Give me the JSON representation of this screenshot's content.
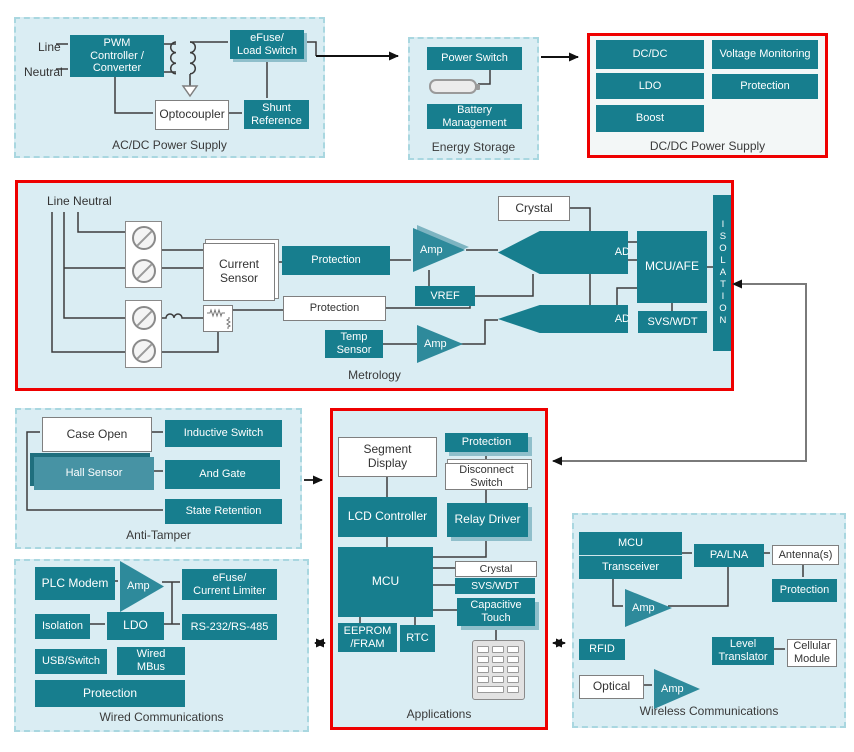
{
  "colors": {
    "teal": "#177E8E",
    "teal_light": "#4793A4",
    "amp_teal": "#2E8A9B",
    "container_bg": "#DAEDF3",
    "container_border": "#A9D7E0",
    "highlight_red": "#EE0000",
    "wire": "#3C3C3C",
    "link_gray": "#7A7A7A"
  },
  "acdc": {
    "title": "AC/DC Power Supply",
    "line_label": "Line",
    "neutral_label": "Neutral",
    "pwm": "PWM\nController /\nConverter",
    "efuse": "eFuse/\nLoad Switch",
    "optocoupler": "Optocoupler",
    "shunt_reference": "Shunt\nReference"
  },
  "energy": {
    "title": "Energy Storage",
    "power_switch": "Power Switch",
    "battery_management": "Battery\nManagement"
  },
  "dcdc": {
    "title": "DC/DC Power Supply",
    "dcdc": "DC/DC",
    "voltage_monitoring": "Voltage Monitoring",
    "ldo": "LDO",
    "protection": "Protection",
    "boost": "Boost"
  },
  "metrology": {
    "title": "Metrology",
    "line_neutral": "Line Neutral",
    "current_sensor": "Current\nSensor",
    "protection_top": "Protection",
    "protection_bottom": "Protection",
    "temp_sensor": "Temp\nSensor",
    "amp_top": "Amp",
    "amp_bottom": "Amp",
    "adc_top": "ADC",
    "adc_bottom": "ADC",
    "vref": "VREF",
    "crystal": "Crystal",
    "mcu_afe": "MCU/AFE",
    "svs_wdt": "SVS/WDT",
    "isolation": "ISOLATION"
  },
  "anti_tamper": {
    "title": "Anti-Tamper",
    "case_open": "Case Open",
    "inductive_switch": "Inductive Switch",
    "hall_sensor": "Hall Sensor",
    "and_gate": "And Gate",
    "state_retention": "State Retention"
  },
  "applications": {
    "title": "Applications",
    "segment_display": "Segment\nDisplay",
    "protection": "Protection",
    "disconnect_switch": "Disconnect\nSwitch",
    "lcd_controller": "LCD Controller",
    "relay_driver": "Relay Driver",
    "mcu": "MCU",
    "crystal": "Crystal",
    "svs_wdt": "SVS/WDT",
    "capacitive_touch": "Capacitive\nTouch",
    "eeprom_fram": "EEPROM\n/FRAM",
    "rtc": "RTC"
  },
  "wired": {
    "title": "Wired Communications",
    "plc_modem": "PLC Modem",
    "amp": "Amp",
    "efuse_current_limiter": "eFuse/\nCurrent Limiter",
    "isolation": "Isolation",
    "ldo": "LDO",
    "rs232_rs485": "RS-232/RS-485",
    "usb_switch": "USB/Switch",
    "wired_mbus": "Wired\nMBus",
    "protection": "Protection"
  },
  "wireless": {
    "title": "Wireless Communications",
    "mcu": "MCU",
    "transceiver": "Transceiver",
    "pa_lna": "PA/LNA",
    "antennas": "Antenna(s)",
    "protection": "Protection",
    "amp_top": "Amp",
    "amp_bottom": "Amp",
    "rfid": "RFID",
    "level_translator": "Level\nTranslator",
    "cellular_module": "Cellular\nModule",
    "optical": "Optical"
  }
}
